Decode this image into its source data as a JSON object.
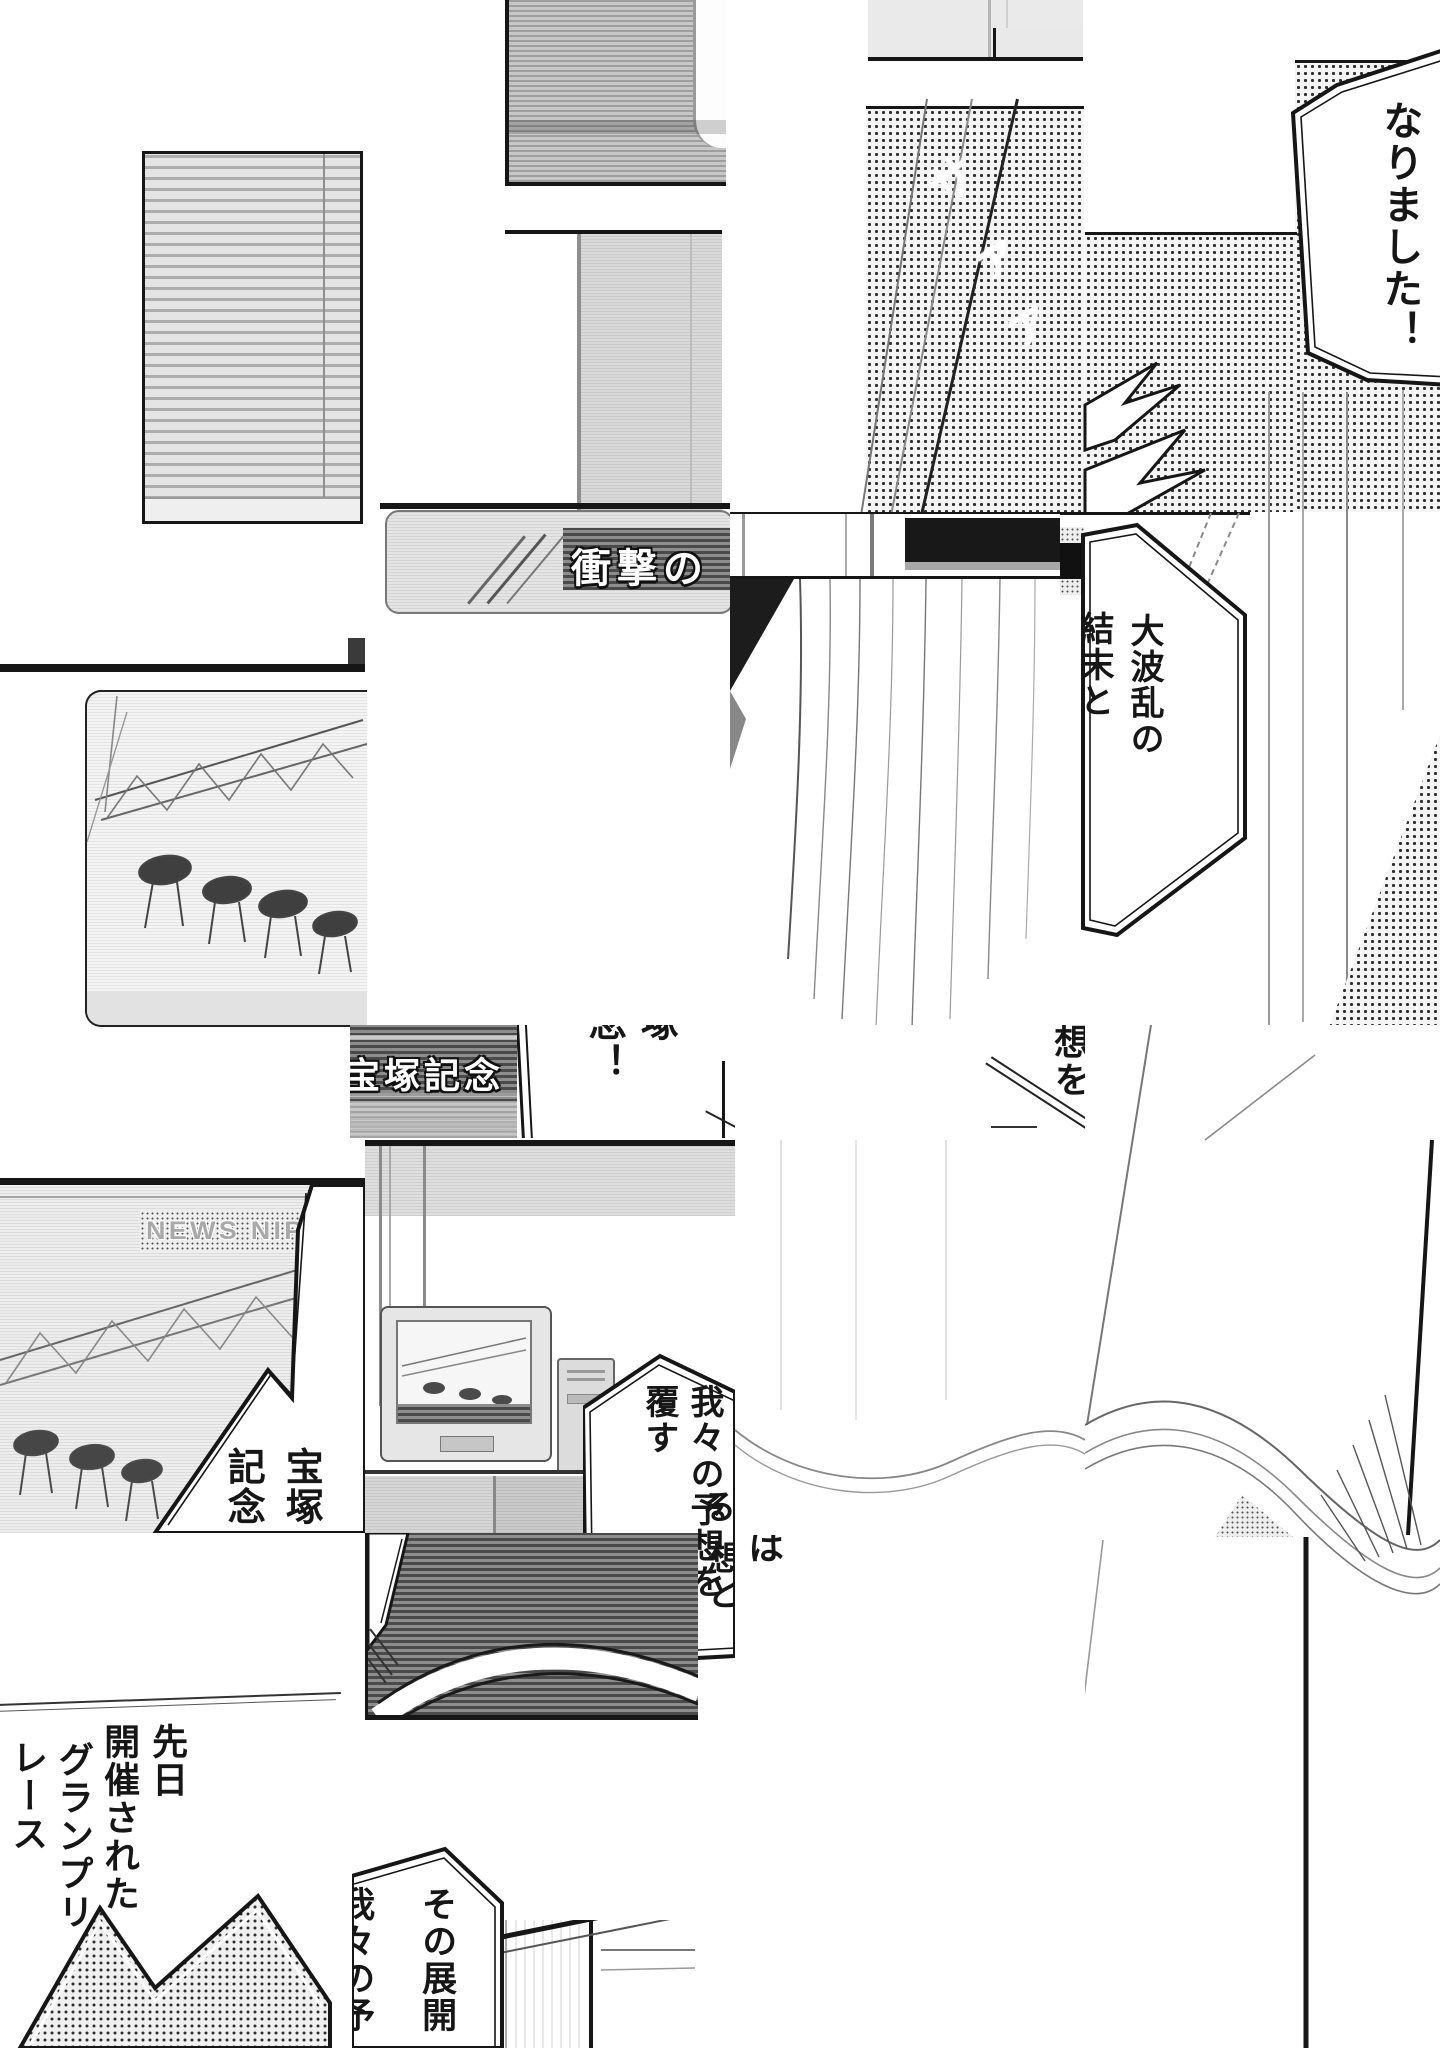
{
  "page_type": "scrambled-manga-page",
  "bubbles": {
    "narimashita": "なりました！",
    "daiharan_col1": "大波乱の",
    "daiharan_col2": "結末と",
    "takarazuka_col1": "宝塚",
    "takarazuka_col2": "記念",
    "kinen_frag_right": "塚",
    "kinen_frag_left": "念！",
    "souwo_frag": "想を",
    "wareware_col1": "我々の予想を",
    "wareware_col2": "覆す",
    "frag_wa": "は",
    "frag_ru": "る",
    "frag_souto": "想と",
    "senjitsu_col1": "先日",
    "senjitsu_col2": "開催された",
    "senjitsu_col3": "グランプリ",
    "senjitsu_col4": "レース",
    "sono_col1": "その展開",
    "sono_col2_clipped": "我々の予"
  },
  "sfx": {
    "s1": "サ",
    "s2": "ァ",
    "s3": "ァ"
  },
  "tv": {
    "shougeki_banner": "衝撃の",
    "takarazuka_banner": "宝塚記念",
    "news_banner": "NEWS NIP"
  },
  "colors": {
    "ink": "#161616",
    "paper": "#ffffff",
    "tone_gray": "#8d8d8d",
    "screen_gray": "#ededed"
  }
}
